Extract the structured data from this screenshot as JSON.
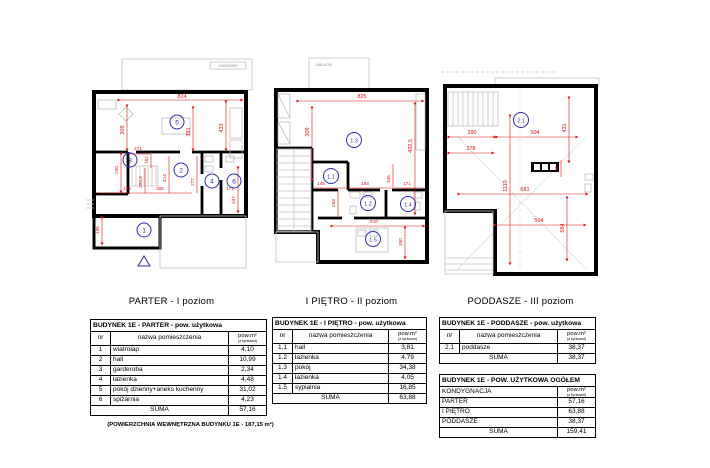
{
  "colors": {
    "dim": "#e01010",
    "room": "#2b2bb8",
    "wall": "#000000",
    "fixture": "#b5b5b5",
    "muted": "#8a8a8a"
  },
  "plans": [
    {
      "caption": "PARTER - I poziom",
      "outdoor_label": "OGRÓDEK",
      "rooms": [
        "5",
        "3",
        "2",
        "4",
        "6",
        "1"
      ],
      "dims": [
        "824",
        "309",
        "391",
        "433",
        "271",
        "162",
        "200",
        "129",
        "295,5",
        "305",
        "414",
        "277",
        "171",
        "247",
        "155"
      ]
    },
    {
      "caption": "I PIĘTRO - II poziom",
      "outdoor_label": "BALKON",
      "rooms": [
        "1.3",
        "1.1",
        "1.2",
        "1.4",
        "1.5"
      ],
      "dims": [
        "825",
        "309",
        "432,5",
        "145",
        "193",
        "445",
        "171",
        "263",
        "510",
        "330"
      ]
    },
    {
      "caption": "PODDASZE - III poziom",
      "rooms": [
        "2.1"
      ],
      "dims": [
        "290",
        "504",
        "431",
        "278",
        "95",
        "1110",
        "681",
        "504",
        "584"
      ]
    }
  ],
  "tables": [
    {
      "title": "BUDYNEK 1E -  PARTER - pow. użytkowa",
      "headers": {
        "nr": "nr",
        "name": "nazwa pomieszczenia",
        "area": "pow.m²",
        "area_sub": "(z tynkami)"
      },
      "rows": [
        [
          "1",
          "wiatrołap",
          "4,10"
        ],
        [
          "2",
          "hall",
          "10,99"
        ],
        [
          "3",
          "garderoba",
          "2,34"
        ],
        [
          "4",
          "łazienka",
          "4,48"
        ],
        [
          "5",
          "pokój dzienny+aneks kuchenny",
          "31,02"
        ],
        [
          "6",
          "spiżarnia",
          "4,23"
        ]
      ],
      "suma_label": "SUMA",
      "suma_value": "57,16"
    },
    {
      "title": "BUDYNEK 1E  - I PIĘTRO - pow. użytkowa",
      "headers": {
        "nr": "nr",
        "name": "nazwa pomieszczenia",
        "area": "pow.m²",
        "area_sub": "(z tynkami)"
      },
      "rows": [
        [
          "1.1",
          "hall",
          "3,81"
        ],
        [
          "1.2",
          "łazienka",
          "4,79"
        ],
        [
          "1.3",
          "pokój",
          "34,38"
        ],
        [
          "1.4",
          "łazienka",
          "4,05"
        ],
        [
          "1.5",
          "sypialnia",
          "16,85"
        ]
      ],
      "suma_label": "SUMA",
      "suma_value": "63,88"
    },
    {
      "title": "BUDYNEK 1E -  PODDASZE - pow. użytkowa",
      "headers": {
        "nr": "nr",
        "name": "nazwa pomieszczenia",
        "area": "pow.m²",
        "area_sub": "(z tynkami)"
      },
      "rows": [
        [
          "2.1",
          "poddasze",
          "38,37"
        ]
      ],
      "suma_label": "SUMA",
      "suma_value": "38,37"
    },
    {
      "title": "BUDYNEK 1E -  POW. UŻYTKOWA  OGÓŁEM",
      "headers": {
        "name": "KONDYGNACJA",
        "area": "pow.m²",
        "area_sub": "(z tynkami)"
      },
      "rows": [
        [
          "PARTER",
          "57,16"
        ],
        [
          "I PIĘTRO",
          "63,88"
        ],
        [
          "PODDASZE",
          "38,37"
        ]
      ],
      "suma_label": "SUMA",
      "suma_value": "159,41"
    }
  ],
  "footnote": "(POWIERZCHNIA WEWNĘTRZNA BUDYNKU 1E - 187,15 m²)"
}
